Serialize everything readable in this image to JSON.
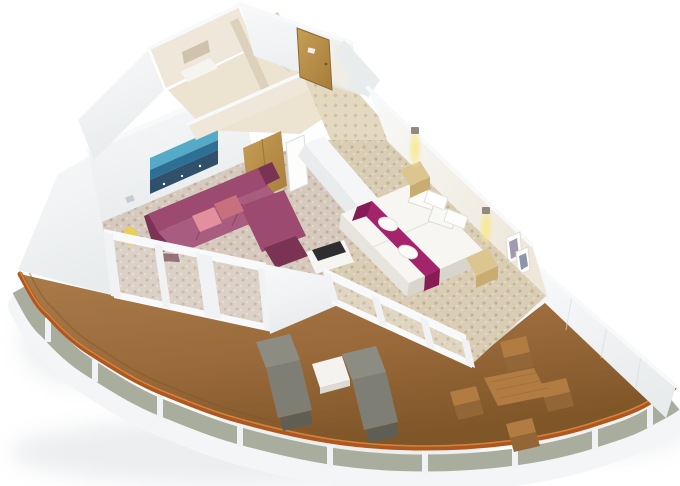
{
  "scene": {
    "type": "3d-isometric-floorplan-render",
    "description": "Cutaway 3D floor plan of a cruise-ship corner suite: bathroom and entry hall at top, living room with sectional sofa and wall art, bedroom with double bed and lit sconces, and a large curved wrap-around balcony with teak deck, two sun loungers, a side table and a four-chair dining set behind a glass railing.",
    "rooms": [
      "bathroom",
      "entry-hall",
      "living-room",
      "bedroom",
      "balcony"
    ]
  },
  "colors": {
    "background": "#ffffff",
    "hull": "#f3f5f6",
    "hull_edge": "#dfe4e7",
    "shadow": "#c7ccd1",
    "glass": "#a9ad9d",
    "post": "#f0f2f3",
    "handrail": "#b0571f",
    "handrail_light": "#d6873f",
    "deck_light": "#aa7b49",
    "deck_mid": "#99693a",
    "deck_dark": "#7f5628",
    "wall": "#f8f9fa",
    "wall_shade": "#e9eced",
    "wall_dark": "#d7dcdf",
    "inner_wall": "#efe8da",
    "inner_wall_dark": "#ddd1bb",
    "bath_floor": "#ece3d0",
    "tile": "#e3d8c0",
    "tile_dot": "#cfc0a2",
    "carpet_living": "#d6c9bd",
    "carpet_living_dot": "#c2ae9e",
    "carpet_living_light": "#e3d9ce",
    "carpet_bed": "#d9cdb5",
    "carpet_bed_dot": "#c4b194",
    "carpet_bed_light": "#e6ddc9",
    "door_wood": "#c79e56",
    "door_wood_dark": "#a67c3a",
    "closet_door": "#f1ede3",
    "wardrobe": "#d9c28e",
    "sofa": "#9c4a70",
    "sofa_dark": "#7b3354",
    "sofa_light": "#a85c80",
    "sofa_shadow": "#5e2740",
    "pillow": "#e28f9e",
    "pillow_dark": "#c9707f",
    "art_sky": "#55aac8",
    "art_sea": "#2e7095",
    "art_dark": "#31506b",
    "bed": "#f7f6f2",
    "bed_side": "#e6e4dd",
    "bed_dark": "#d8d5cc",
    "runner": "#a3246a",
    "runner_dark": "#861b55",
    "towel": "#fbfbf9",
    "nightstand": "#ddc58f",
    "nightstand_dark": "#c8ac72",
    "glow": "#f8e88e",
    "sconce": "#8f8a83",
    "lounger": "#8d8c82",
    "lounger_dark": "#7f7e74",
    "lounger_frame": "#5f5e55",
    "side_table": "#f4f3ef",
    "side_table_edge": "#dcdcd4",
    "teak": "#b07c42",
    "teak_dark": "#926637",
    "tv": "#2e2e31",
    "cabinet": "#f5f5f2",
    "frame_art": "#a29bb0",
    "frame_art2": "#8d96a8",
    "lamp_yellow": "#e9cf52",
    "switch": "#c9ccce",
    "fixture": "#f6f4ee",
    "mirror": "#cfc3ad",
    "divider": "#f4f6f7",
    "glass_sheen": "#ffffff"
  }
}
